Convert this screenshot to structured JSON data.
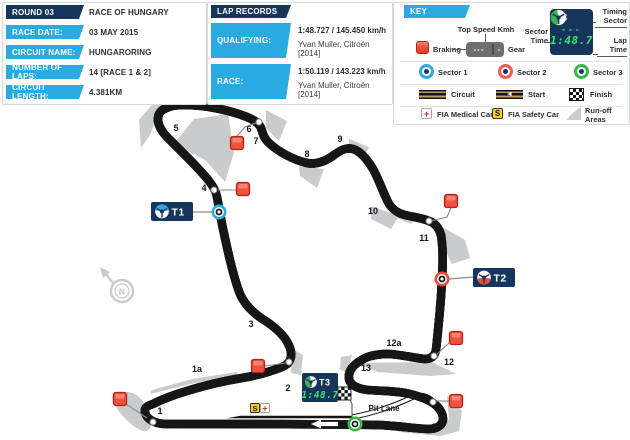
{
  "colors": {
    "navy": "#16355d",
    "cyan": "#29abe2",
    "red": "#ef4a36",
    "green": "#3ab54a",
    "track_tan": "#c49a5e",
    "runoff": "#c9cbcd",
    "digital": "#35e56e"
  },
  "info_panel": {
    "rows": [
      {
        "label": "ROUND 03",
        "value": "RACE OF HUNGARY",
        "header": true
      },
      {
        "label": "RACE DATE:",
        "value": "03 MAY 2015"
      },
      {
        "label": "CIRCUIT NAME:",
        "value": "HUNGARORING"
      },
      {
        "label": "NUMBER OF LAPS:",
        "value": "14 [RACE 1 & 2]"
      },
      {
        "label": "CIRCUIT LENGTH:",
        "value": "4.381KM"
      }
    ]
  },
  "lap_records": {
    "header": "LAP RECORDS",
    "rows": [
      {
        "label": "QUALIFYING:",
        "time": "1:48.727 / 145.450 km/h",
        "driver": "Yvan Muller, Citroën [2014]"
      },
      {
        "label": "RACE:",
        "time": "1:50.119 / 143.223 km/h",
        "driver": "Yvan Muller, Citroën [2014]"
      }
    ]
  },
  "key": {
    "header": "KEY",
    "braking": "Braking",
    "top_speed": "Top Speed Kmh",
    "gear": "Gear",
    "gear_display": {
      "left": "---",
      "right": "-"
    },
    "sector_time": "Sector Time",
    "timing_sector": "Timing Sector",
    "lap_time": "Lap Time",
    "badge": {
      "label": "T3",
      "dashes": "---",
      "time": "1:48.7"
    },
    "sectors": [
      {
        "label": "Sector 1",
        "color": "#29abe2"
      },
      {
        "label": "Sector 2",
        "color": "#f15b4c"
      },
      {
        "label": "Sector 3",
        "color": "#3ab54a"
      }
    ],
    "circuit": "Circuit",
    "start": "Start",
    "start_arrow_glyph": "◄",
    "finish": "Finish",
    "medical": "FIA Medical Car",
    "medical_glyph": "+",
    "safety": "FIA Safety Car",
    "safety_glyph": "S",
    "runoff": "Run-off Areas"
  },
  "map": {
    "compass": "N",
    "pit_lane": "Pit Lane",
    "safety_car": "S",
    "medical_car": "+",
    "corners": [
      {
        "label": "1",
        "x": 160,
        "y": 414
      },
      {
        "label": "1a",
        "x": 197,
        "y": 372
      },
      {
        "label": "2",
        "x": 288,
        "y": 391
      },
      {
        "label": "3",
        "x": 251,
        "y": 327
      },
      {
        "label": "4",
        "x": 204,
        "y": 191
      },
      {
        "label": "5",
        "x": 176,
        "y": 131
      },
      {
        "label": "6",
        "x": 249,
        "y": 132
      },
      {
        "label": "7",
        "x": 256,
        "y": 144
      },
      {
        "label": "8",
        "x": 307,
        "y": 157
      },
      {
        "label": "9",
        "x": 340,
        "y": 142
      },
      {
        "label": "10",
        "x": 373,
        "y": 214
      },
      {
        "label": "11",
        "x": 424,
        "y": 241
      },
      {
        "label": "12",
        "x": 449,
        "y": 365
      },
      {
        "label": "12a",
        "x": 394,
        "y": 346
      },
      {
        "label": "13",
        "x": 366,
        "y": 371
      },
      {
        "label": "14",
        "x": 436,
        "y": 430
      }
    ],
    "sector_badges": [
      {
        "label": "T1",
        "color": "#29abe2",
        "sector": "top",
        "bx": 151,
        "by": 202,
        "w": 42,
        "h": 19,
        "mx": 219,
        "my": 212,
        "line": [
          [
            193,
            212
          ],
          [
            212,
            212
          ]
        ]
      },
      {
        "label": "T2",
        "color": "#ef4a36",
        "sector": "bottom",
        "bx": 473,
        "by": 268,
        "w": 42,
        "h": 19,
        "mx": 442,
        "my": 279,
        "line": [
          [
            449,
            279
          ],
          [
            473,
            277
          ]
        ]
      },
      {
        "label": "T3",
        "color": "#3ab54a",
        "sector": "left",
        "bx": 302,
        "by": 373,
        "w": 36,
        "h": 29,
        "mx": 355,
        "my": 424,
        "time": "1:48.7"
      }
    ],
    "braking_points": [
      {
        "x": 120,
        "y": 399,
        "line": [
          [
            126,
            404
          ],
          [
            147,
            418
          ]
        ]
      },
      {
        "x": 258,
        "y": 366,
        "line": [
          [
            265,
            366
          ],
          [
            286,
            363
          ]
        ]
      },
      {
        "x": 243,
        "y": 189,
        "line": [
          [
            236,
            190
          ],
          [
            218,
            190
          ]
        ]
      },
      {
        "x": 237,
        "y": 143,
        "line": [
          [
            237,
            136
          ],
          [
            245,
            127
          ],
          [
            256,
            123
          ]
        ]
      },
      {
        "x": 451,
        "y": 201,
        "line": [
          [
            451,
            208
          ],
          [
            447,
            217
          ],
          [
            431,
            221
          ]
        ]
      },
      {
        "x": 456,
        "y": 338,
        "line": [
          [
            449,
            343
          ],
          [
            436,
            355
          ]
        ]
      },
      {
        "x": 456,
        "y": 401,
        "line": [
          [
            449,
            401
          ],
          [
            436,
            401
          ]
        ]
      }
    ],
    "turn_dots": [
      [
        153,
        422
      ],
      [
        289,
        362
      ],
      [
        214,
        190
      ],
      [
        259,
        122
      ],
      [
        429,
        221
      ],
      [
        434,
        356
      ],
      [
        433,
        402
      ]
    ]
  }
}
